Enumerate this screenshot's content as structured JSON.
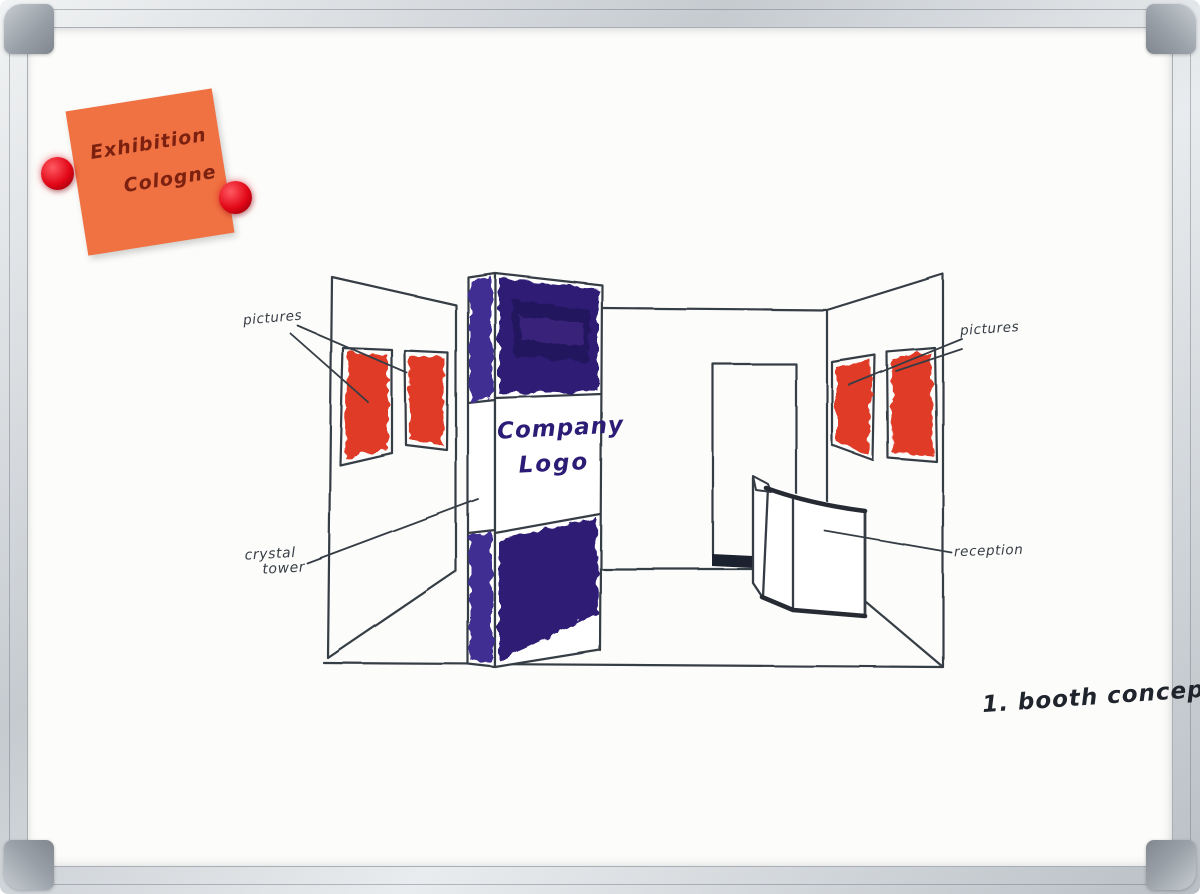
{
  "note": {
    "line1": "Exhibition",
    "line2": "Cologne"
  },
  "labels": {
    "pictures_left": "pictures",
    "pictures_right": "pictures",
    "crystal_line1": "crystal",
    "crystal_line2": "tower",
    "reception": "reception"
  },
  "tower": {
    "logo_line1": "Company",
    "logo_line2": "Logo"
  },
  "caption": "1. booth concept",
  "colors": {
    "picture_red": "#e03a28",
    "tower_indigo": "#2e1c74",
    "tower_indigo_side": "#3f2d92",
    "tower_indigo_dark": "#211257",
    "note_orange": "#f07243",
    "note_text": "#7c2110",
    "magnet_red": "#e20717",
    "ink": "#363c45",
    "logo_ink": "#2c1c76"
  }
}
